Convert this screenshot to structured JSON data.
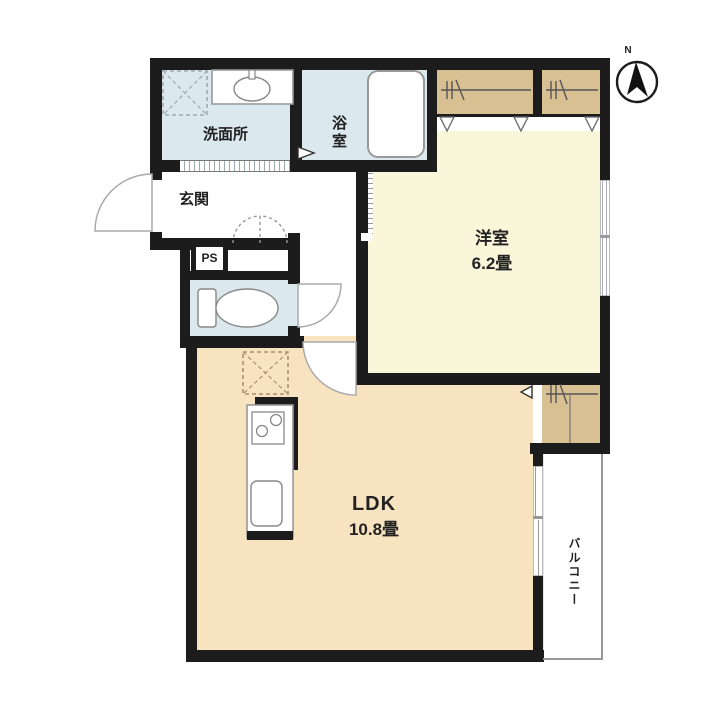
{
  "plan": {
    "compass": {
      "label": "N"
    },
    "rooms": {
      "washroom": {
        "label": "洗面所"
      },
      "bathroom": {
        "label": "浴室"
      },
      "entrance": {
        "label": "玄関"
      },
      "pipe_space": {
        "label": "PS"
      },
      "western_room": {
        "label": "洋室",
        "size": "6.2畳"
      },
      "ldk": {
        "label": "LDK",
        "size": "10.8畳"
      },
      "balcony": {
        "label": "バルコニー"
      }
    },
    "fixtures": {
      "bathtub": "bathtub-icon",
      "toilet": "toilet-icon",
      "vanity_sink": "sink-icon",
      "washing_machine_pan": "dashed-x-square-icon",
      "refrigerator_space": "dashed-x-square-icon",
      "kitchen_stove": "two-burner-stove-icon",
      "kitchen_sink": "kitchen-sink-icon",
      "closet_hanger": "hanger-rod-icon",
      "north_arrow": "compass-icon"
    },
    "colors": {
      "wall": "#1c1c1c",
      "wet_area": "#dbe9ee",
      "western_room": "#faf6da",
      "ldk": "#f8e3c1",
      "closet": "#d8c093",
      "fixture_outline": "#999999",
      "door_arc": "#aaaaaa",
      "label_text": "#222222",
      "balcony_line": "#999999"
    }
  }
}
